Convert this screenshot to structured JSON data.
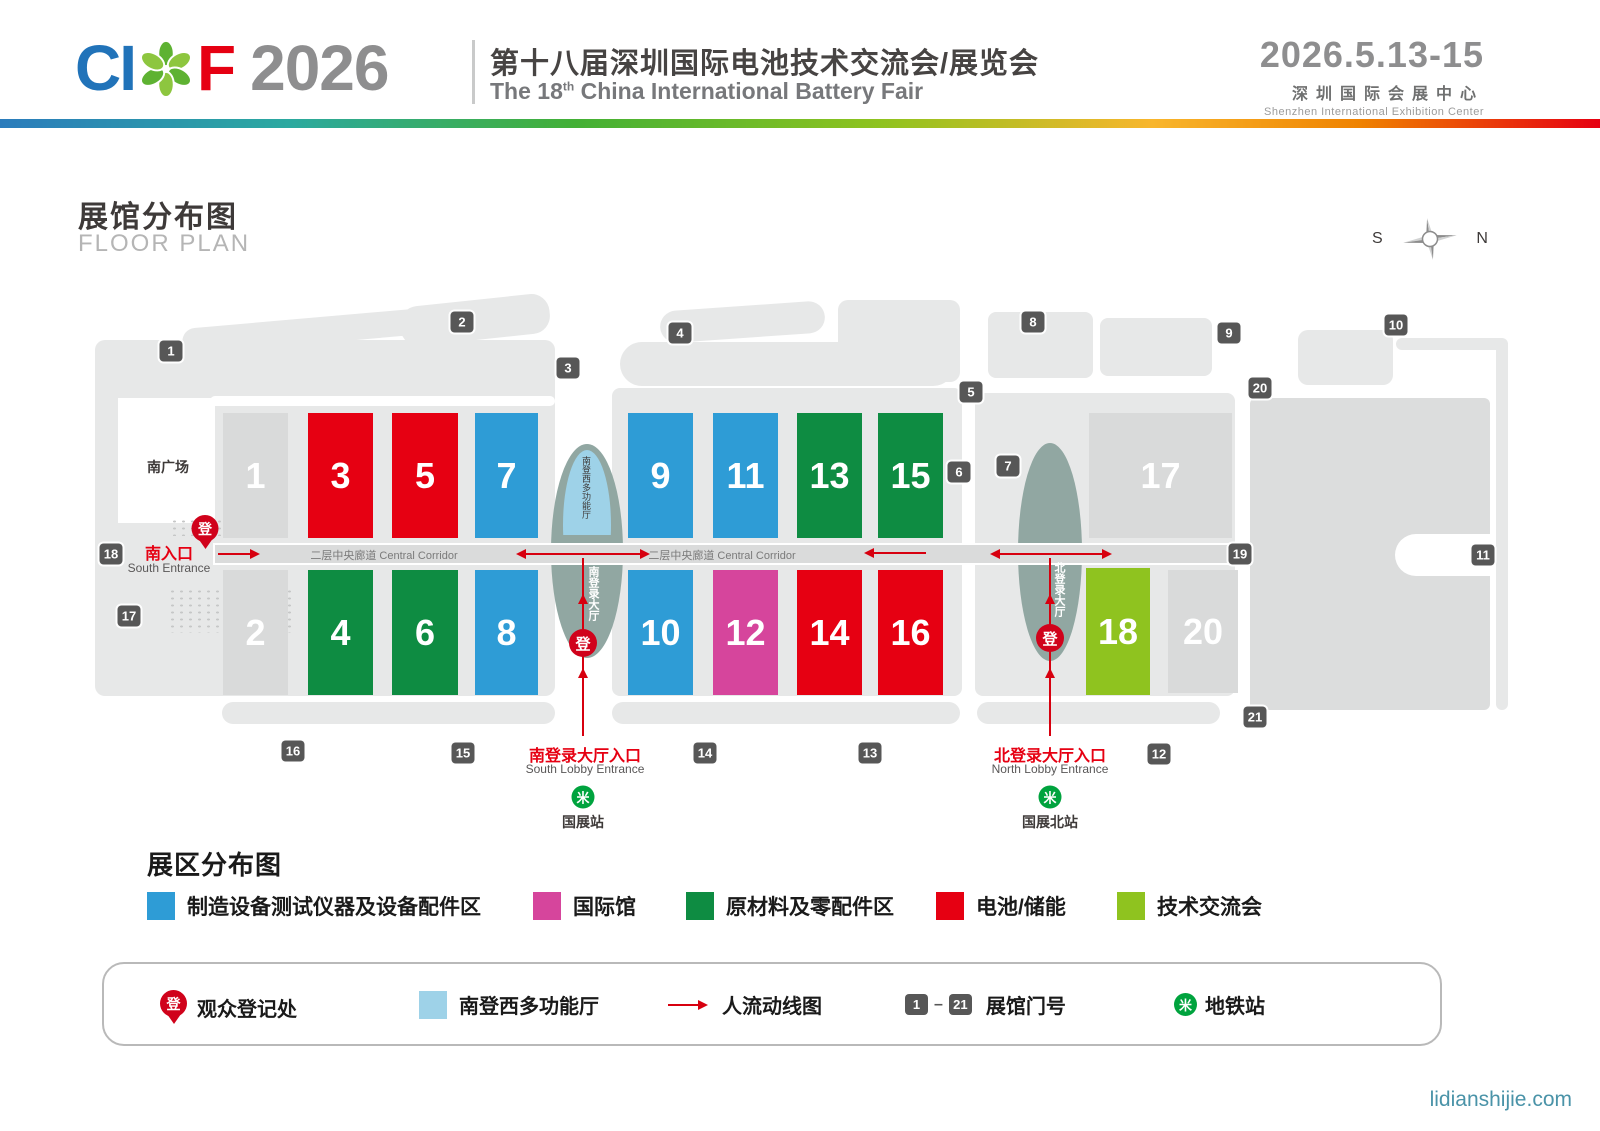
{
  "header": {
    "logo_c": "C",
    "logo_i": "I",
    "logo_f": "F",
    "logo_year": "2026",
    "title_cn": "第十八届深圳国际电池技术交流会/展览会",
    "title_en_prefix": "The 18",
    "title_en_sup": "th",
    "title_en_suffix": " China International Battery Fair",
    "dates": "2026.5.13-15",
    "venue_cn": "深圳国际会展中心",
    "venue_en": "Shenzhen International Exhibition Center"
  },
  "floor_plan": {
    "title_cn": "展馆分布图",
    "title_en": "FLOOR PLAN",
    "compass_south": "S",
    "compass_north": "N",
    "south_plaza": "南广场",
    "south_entrance_cn": "南入口",
    "south_entrance_en": "South Entrance",
    "corridor_label": "二层中央廊道 Central Corridor",
    "corridor_label_positions": [
      384,
      722
    ],
    "south_multi_vertical": "南登西多功能厅",
    "south_lobby_vertical": "南登录大厅",
    "north_lobby_vertical": "北登录大厅",
    "reg_char": "登",
    "metro_glyph": "米",
    "south_lobby_entrance_cn": "南登录大厅入口",
    "south_lobby_entrance_en": "South Lobby Entrance",
    "north_lobby_entrance_cn": "北登录大厅入口",
    "north_lobby_entrance_en": "North Lobby Entrance",
    "metro_station_south": "国展站",
    "metro_station_north": "国展北站",
    "halls": [
      {
        "n": "1",
        "x": 223,
        "y": 413,
        "w": 65,
        "h": 125,
        "cat": "none"
      },
      {
        "n": "3",
        "x": 308,
        "y": 413,
        "w": 65,
        "h": 125,
        "cat": "battery"
      },
      {
        "n": "5",
        "x": 392,
        "y": 413,
        "w": 66,
        "h": 125,
        "cat": "battery"
      },
      {
        "n": "7",
        "x": 475,
        "y": 413,
        "w": 63,
        "h": 125,
        "cat": "equipment"
      },
      {
        "n": "9",
        "x": 628,
        "y": 413,
        "w": 65,
        "h": 125,
        "cat": "equipment"
      },
      {
        "n": "11",
        "x": 713,
        "y": 413,
        "w": 65,
        "h": 125,
        "cat": "equipment"
      },
      {
        "n": "13",
        "x": 797,
        "y": 413,
        "w": 65,
        "h": 125,
        "cat": "materials"
      },
      {
        "n": "15",
        "x": 878,
        "y": 413,
        "w": 65,
        "h": 125,
        "cat": "materials"
      },
      {
        "n": "17",
        "x": 1089,
        "y": 413,
        "w": 143,
        "h": 125,
        "cat": "none"
      },
      {
        "n": "2",
        "x": 223,
        "y": 570,
        "w": 65,
        "h": 125,
        "cat": "none"
      },
      {
        "n": "4",
        "x": 308,
        "y": 570,
        "w": 65,
        "h": 125,
        "cat": "materials"
      },
      {
        "n": "6",
        "x": 392,
        "y": 570,
        "w": 66,
        "h": 125,
        "cat": "materials"
      },
      {
        "n": "8",
        "x": 475,
        "y": 570,
        "w": 63,
        "h": 125,
        "cat": "equipment"
      },
      {
        "n": "10",
        "x": 628,
        "y": 570,
        "w": 65,
        "h": 125,
        "cat": "equipment"
      },
      {
        "n": "12",
        "x": 713,
        "y": 570,
        "w": 65,
        "h": 125,
        "cat": "international"
      },
      {
        "n": "14",
        "x": 797,
        "y": 570,
        "w": 65,
        "h": 125,
        "cat": "battery"
      },
      {
        "n": "16",
        "x": 878,
        "y": 570,
        "w": 65,
        "h": 125,
        "cat": "battery"
      },
      {
        "n": "18",
        "x": 1086,
        "y": 568,
        "w": 64,
        "h": 127,
        "cat": "conference"
      },
      {
        "n": "20",
        "x": 1168,
        "y": 570,
        "w": 70,
        "h": 123,
        "cat": "none"
      }
    ],
    "gates": [
      {
        "n": "1",
        "x": 171,
        "y": 351
      },
      {
        "n": "2",
        "x": 462,
        "y": 322
      },
      {
        "n": "3",
        "x": 568,
        "y": 368
      },
      {
        "n": "4",
        "x": 680,
        "y": 333
      },
      {
        "n": "5",
        "x": 971,
        "y": 392
      },
      {
        "n": "6",
        "x": 959,
        "y": 472
      },
      {
        "n": "7",
        "x": 1008,
        "y": 466
      },
      {
        "n": "8",
        "x": 1033,
        "y": 322
      },
      {
        "n": "9",
        "x": 1229,
        "y": 333
      },
      {
        "n": "10",
        "x": 1396,
        "y": 325
      },
      {
        "n": "11",
        "x": 1483,
        "y": 555
      },
      {
        "n": "12",
        "x": 1159,
        "y": 754
      },
      {
        "n": "13",
        "x": 870,
        "y": 753
      },
      {
        "n": "14",
        "x": 705,
        "y": 753
      },
      {
        "n": "15",
        "x": 463,
        "y": 753
      },
      {
        "n": "16",
        "x": 293,
        "y": 751
      },
      {
        "n": "17",
        "x": 129,
        "y": 616
      },
      {
        "n": "18",
        "x": 111,
        "y": 554
      },
      {
        "n": "19",
        "x": 1240,
        "y": 554
      },
      {
        "n": "20",
        "x": 1260,
        "y": 388
      },
      {
        "n": "21",
        "x": 1255,
        "y": 717
      }
    ],
    "flow_h": [
      {
        "x1": 218,
        "x2": 252,
        "y": 554,
        "head": "right"
      },
      {
        "x1": 524,
        "x2": 585,
        "y": 554,
        "head": "left"
      },
      {
        "x1": 585,
        "x2": 642,
        "y": 554,
        "head": "right"
      },
      {
        "x1": 872,
        "x2": 926,
        "y": 553,
        "head": "left"
      },
      {
        "x1": 998,
        "x2": 1050,
        "y": 554,
        "head": "left"
      },
      {
        "x1": 1050,
        "x2": 1104,
        "y": 554,
        "head": "right"
      }
    ],
    "flow_v": [
      {
        "x": 583,
        "y1": 558,
        "y2": 736,
        "heads": [
          598,
          672
        ]
      },
      {
        "x": 1050,
        "y1": 558,
        "y2": 736,
        "heads": [
          598,
          672
        ]
      }
    ]
  },
  "legend": {
    "title": "展区分布图",
    "items": [
      {
        "color": "#2E9CD6",
        "label": "制造设备测试仪器及设备配件区",
        "x": 147
      },
      {
        "color": "#D6459C",
        "label": "国际馆",
        "x": 533
      },
      {
        "color": "#0E8C42",
        "label": "原材料及零配件区",
        "x": 686
      },
      {
        "color": "#E60012",
        "label": "电池/储能",
        "x": 936
      },
      {
        "color": "#8FC31F",
        "label": "技术交流会",
        "x": 1117
      }
    ]
  },
  "key_box": {
    "reg_label": "观众登记处",
    "multi_label": "南登西多功能厅",
    "flow_label": "人流动线图",
    "gate_from": "1",
    "gate_dash": "–",
    "gate_to": "21",
    "gate_label": "展馆门号",
    "metro_label": "地铁站"
  },
  "footer": {
    "url": "lidianshijie.com"
  },
  "colors": {
    "categories": {
      "equipment": "#2E9CD6",
      "international": "#D6459C",
      "materials": "#0E8C42",
      "battery": "#E60012",
      "conference": "#8FC31F",
      "none": "#D9DADA"
    },
    "flow_red": "#d7000f",
    "gate_dark": "#575757",
    "metro_green": "#00a33e",
    "multi_blue": "#9ED2E8"
  }
}
